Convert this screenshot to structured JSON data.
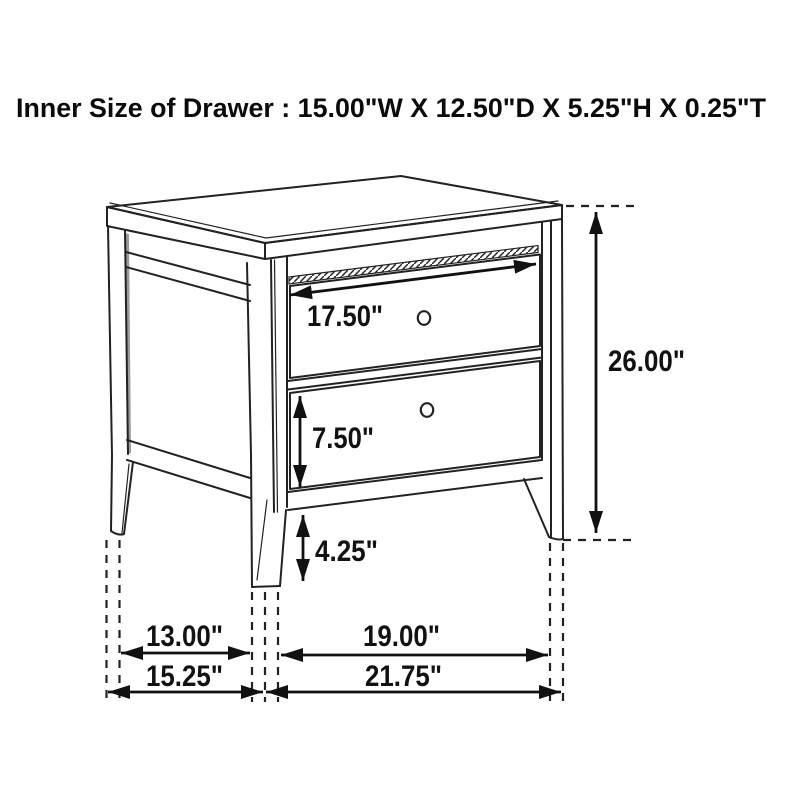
{
  "page": {
    "background": "#ffffff",
    "line_color": "#222222",
    "text_color": "#0b0b0b"
  },
  "title": "Inner Size of Drawer : 15.00\"W X 12.50\"D X 5.25\"H X 0.25\"T",
  "figure": {
    "type": "furniture-dimension-diagram",
    "subject": "two-drawer nightstand",
    "labels": {
      "drawer_width": "17.50\"",
      "lower_drawer_height": "7.50\"",
      "leg_clearance_height": "4.25\"",
      "overall_height": "26.00\"",
      "side_leg_inner_span": "13.00\"",
      "front_leg_inner_span": "19.00\"",
      "overall_depth": "15.25\"",
      "overall_width": "21.75\""
    }
  }
}
